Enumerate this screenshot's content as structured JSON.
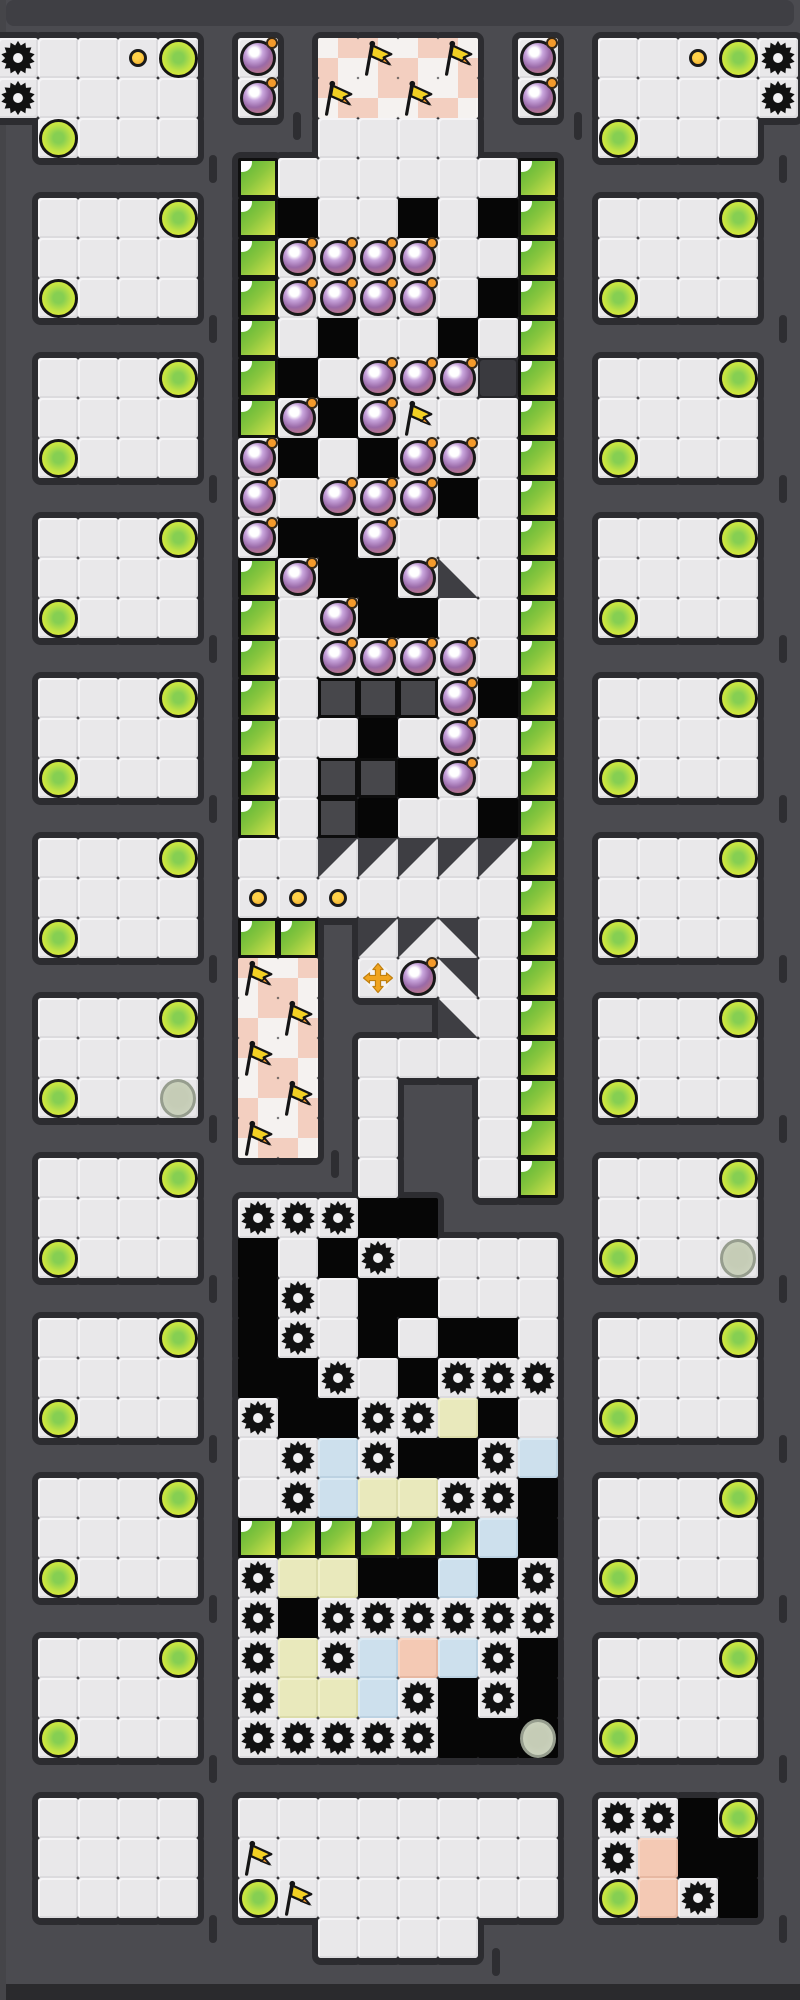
{
  "board": {
    "cell_size": 40,
    "origin_x": -2,
    "origin_y": -2,
    "cols": 20,
    "rows": 50,
    "legend_base": {
      ".": "background",
      "f": "floor-tile",
      "k": "wall-tile",
      "w": "checker-tile",
      "g": "green-block",
      "Y": "yellow-tile",
      "U": "blue-tile",
      "O": "salmon-tile",
      "d": "dark-tile",
      "D": "rock-block",
      "1": "slope-tile-nw",
      "2": "slope-tile-ne",
      "3": "slope-tile-sw"
    },
    "legend_entities": {
      ".": "none",
      "b": "bomb",
      "F": "flag",
      "s": "saw-gear",
      "o": "coin-dot",
      "C": "fruit-orb",
      "c": "ghost-orb",
      "+": "move-cross"
    },
    "base": [
      "....................",
      "fffff.f.wwww.f.fffff",
      "fffff.f.wwww.f.fffff",
      ".ffff...ffff...ffff.",
      "......gffffffg......",
      ".ffff.gkffkfkg.ffff.",
      ".ffff.gffffffg.ffff.",
      ".ffff.gfffffkg.ffff.",
      "......gfkffkfg......",
      ".ffff.gkffffdg.ffff.",
      ".ffff.gfkffffg.ffff.",
      ".ffff.fkfkfffg.ffff.",
      "......fffffkfg......",
      ".ffff.fkkffffg.ffff.",
      ".ffff.gfkkf3fg.ffff.",
      ".ffff.gffkkffg.ffff.",
      "......gffffffg......",
      ".ffff.gfDDDfkg.ffff.",
      ".ffff.gffkfffg.ffff.",
      ".ffff.gfDDkffg.ffff.",
      "......gfDkffkg......",
      ".ffff.ff11111g.ffff.",
      ".ffff.fffffffg.ffff.",
      ".ffff.gg.112fg.ffff.",
      "......ww.ff2fg......",
      ".ffff.ww...3fg.ffff.",
      ".ffff.ww.ffffg.ffff.",
      ".ffff.ww.f..fg.ffff.",
      "......ww.f..fg......",
      ".ffff....f..fg.ffff.",
      ".ffff.fffkk....ffff.",
      ".ffff.kfkfffff.ffff.",
      "......kffkkfff......",
      ".ffff.kffkfkkf.ffff.",
      ".ffff.kkffkfff.ffff.",
      ".ffff.fkkffYkf.ffff.",
      "......ffUfkkfU......",
      ".ffff.ffUYYffk.ffff.",
      ".ffff.ggggggUk.ffff.",
      ".ffff.fYYkkUkf.ffff.",
      "......fkffffff......",
      ".ffff.fYfUOUfk.ffff.",
      ".ffff.fYYUfkfk.ffff.",
      ".ffff.fffffkkk.ffff.",
      "....................",
      ".ffff.ffffffff.ffkf.",
      ".ffff.ffffffff.fOkk.",
      ".ffff.ffffffff.fOfk.",
      "........ffff........",
      "...................."
    ],
    "entities": [
      "....................",
      "s..oC.b..F.F.b...oCs",
      "s.....b.F.F..b.....s",
      ".C.............C....",
      "....................",
      "....C.............C.",
      ".......bbbb.........",
      ".C.....bbbb....C....",
      "....................",
      "....C....bbb......C.",
      ".......b.bF.........",
      ".C....b...bb...C....",
      "......b.bbb.........",
      "....C.b..b........C.",
      ".......b..b.........",
      ".C......b......C....",
      "........bbbb........",
      "....C......b......C.",
      "...........b........",
      ".C.........b...C....",
      "....................",
      "....C.............C.",
      "......ooo...........",
      ".C.............C....",
      "......F..+b.........",
      "....C..F..........C.",
      "......F.............",
      ".C..c..F.......C....",
      "......F.............",
      "....C.............C.",
      "......sss...........",
      ".C.......s.....C..c.",
      ".......s............",
      "....C..s..........C.",
      "........s..sss......",
      ".C....s..ss....C....",
      ".......s.s..s.......",
      "....C..s...ss.....C.",
      "....................",
      ".C....s......s.C....",
      "......s.ssssss......",
      "....C.s.s...s.....C.",
      "......s...s.s.......",
      ".C....sssss..c.C....",
      "....................",
      "...............ss.C.",
      "......F........s....",
      "......CF.......C.s..",
      "....................",
      "...................."
    ]
  },
  "colors": {
    "background": "#4b4b50",
    "outline_shadow": "#2c2c30",
    "rock_outline": "#0b0b0b",
    "floor": "#e9e8ea",
    "wall": "#060606",
    "checker_white": "#f5f2f0",
    "checker_pink": "#f3cfc0",
    "green_block_dark": "#55b437",
    "green_block_light": "#d9e44c",
    "yellow_tile": "#e9e9bc",
    "blue_tile": "#cde0ed",
    "salmon_tile": "#f4c9b4",
    "bomb_purple": "#9a6aa8",
    "fuse_orange": "#f49b2c",
    "flag_yellow": "#f2d023",
    "flag_tip_orange": "#f2992e",
    "orb_yellow": "#e9f02e",
    "orb_green_core": "#86cf52",
    "ghost_orb": "#ced5c1",
    "coin_dot": "#f0a82a",
    "move_cross_gold": "#f0a41f",
    "gear_black": "#111111"
  },
  "decor": {
    "strips": [
      {
        "x": 6,
        "y": 0,
        "w": 788,
        "h": 26,
        "color": "#3f3f44",
        "radius": 8
      },
      {
        "x": -8,
        "y": 1984,
        "w": 816,
        "h": 22,
        "color": "#2a2a2d",
        "radius": 6
      },
      {
        "x": 0,
        "y": 0,
        "w": 6,
        "h": 2000,
        "color": "#454549",
        "radius": 0
      }
    ],
    "tick_height": 28,
    "ticks": [
      {
        "x": 209,
        "y": 155
      },
      {
        "x": 209,
        "y": 315
      },
      {
        "x": 209,
        "y": 475
      },
      {
        "x": 209,
        "y": 635
      },
      {
        "x": 209,
        "y": 795
      },
      {
        "x": 209,
        "y": 955
      },
      {
        "x": 209,
        "y": 1115
      },
      {
        "x": 209,
        "y": 1275
      },
      {
        "x": 209,
        "y": 1435
      },
      {
        "x": 209,
        "y": 1595
      },
      {
        "x": 209,
        "y": 1755
      },
      {
        "x": 209,
        "y": 1915
      },
      {
        "x": 779,
        "y": 155
      },
      {
        "x": 779,
        "y": 315
      },
      {
        "x": 779,
        "y": 475
      },
      {
        "x": 779,
        "y": 635
      },
      {
        "x": 779,
        "y": 795
      },
      {
        "x": 779,
        "y": 955
      },
      {
        "x": 779,
        "y": 1115
      },
      {
        "x": 779,
        "y": 1275
      },
      {
        "x": 779,
        "y": 1435
      },
      {
        "x": 779,
        "y": 1595
      },
      {
        "x": 779,
        "y": 1755
      },
      {
        "x": 779,
        "y": 1915
      },
      {
        "x": 293,
        "y": 112
      },
      {
        "x": 574,
        "y": 112
      },
      {
        "x": 331,
        "y": 1150
      },
      {
        "x": 492,
        "y": 1948
      }
    ]
  }
}
